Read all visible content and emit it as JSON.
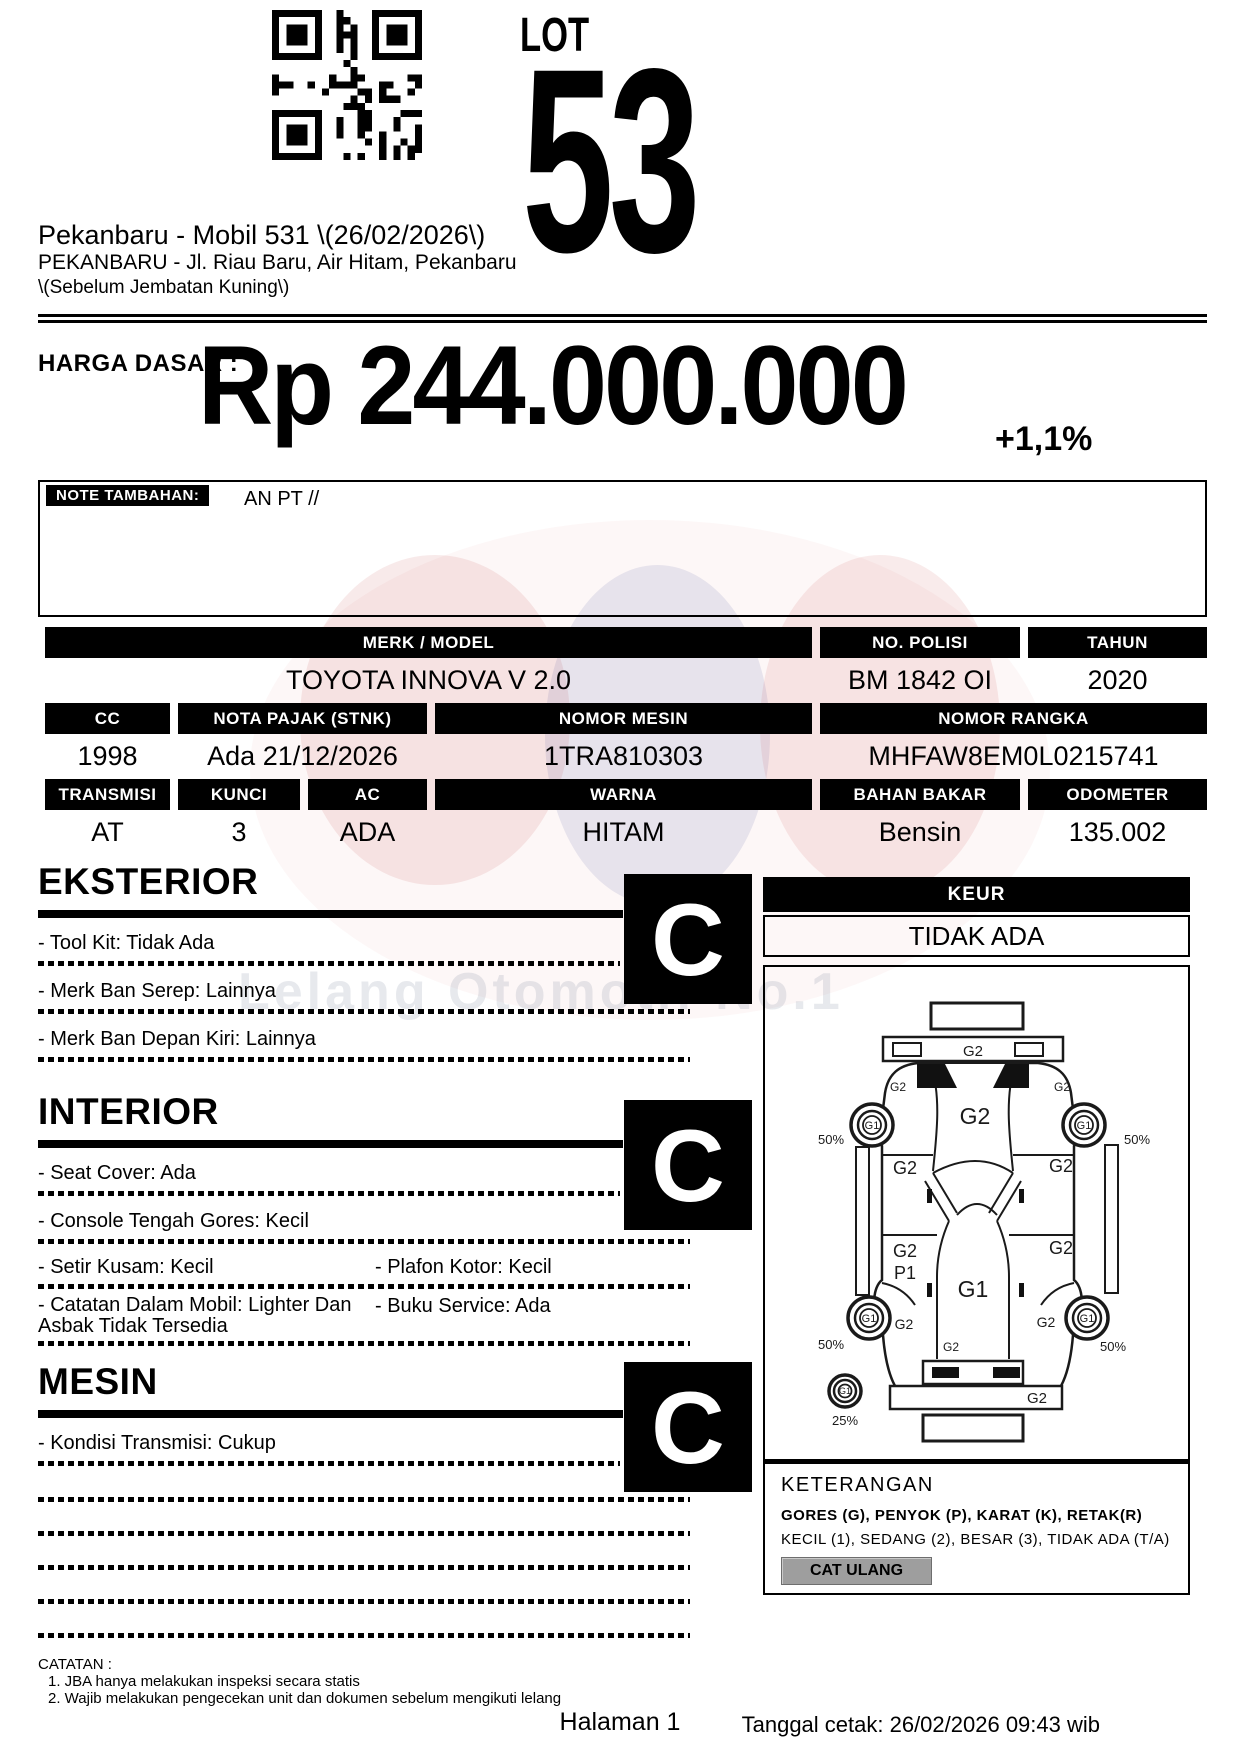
{
  "page": {
    "lot_label": "LOT",
    "lot_number": "53",
    "title": "Pekanbaru - Mobil 531 \\(26/02/2026\\)",
    "address1": "PEKANBARU - Jl. Riau Baru, Air Hitam, Pekanbaru",
    "address2": "\\(Sebelum Jembatan Kuning\\)"
  },
  "price": {
    "label": "HARGA DASAR :",
    "amount": "Rp 244.000.000",
    "change_pct": "+1,1%"
  },
  "note": {
    "label": "NOTE TAMBAHAN:",
    "value": "AN PT //"
  },
  "specs": {
    "merk_model": {
      "label": "MERK / MODEL",
      "value": "TOYOTA INNOVA V 2.0"
    },
    "no_polisi": {
      "label": "NO. POLISI",
      "value": "BM 1842 OI"
    },
    "tahun": {
      "label": "TAHUN",
      "value": "2020"
    },
    "cc": {
      "label": "CC",
      "value": "1998"
    },
    "nota_pajak": {
      "label": "NOTA PAJAK (STNK)",
      "value": "Ada 21/12/2026"
    },
    "nomor_mesin": {
      "label": "NOMOR MESIN",
      "value": "1TRA810303"
    },
    "nomor_rangka": {
      "label": "NOMOR RANGKA",
      "value": "MHFAW8EM0L0215741"
    },
    "transmisi": {
      "label": "TRANSMISI",
      "value": "AT"
    },
    "kunci": {
      "label": "KUNCI",
      "value": "3"
    },
    "ac": {
      "label": "AC",
      "value": "ADA"
    },
    "warna": {
      "label": "WARNA",
      "value": "HITAM"
    },
    "bahan_bakar": {
      "label": "BAHAN BAKAR",
      "value": "Bensin"
    },
    "odometer": {
      "label": "ODOMETER",
      "value": "135.002"
    }
  },
  "sections": {
    "eksterior": {
      "title": "EKSTERIOR",
      "grade": "C",
      "items": [
        "- Tool Kit: Tidak Ada",
        "- Merk Ban Serep: Lainnya",
        "- Merk Ban Depan Kiri: Lainnya"
      ]
    },
    "interior": {
      "title": "INTERIOR",
      "grade": "C",
      "items_full": [
        "- Seat Cover: Ada",
        "- Console Tengah Gores: Kecil"
      ],
      "items_pairs": [
        {
          "left": "- Setir Kusam: Kecil",
          "right": "- Plafon Kotor: Kecil"
        },
        {
          "left": "- Catatan Dalam Mobil: Lighter Dan Asbak Tidak Tersedia",
          "right": "- Buku Service: Ada"
        }
      ]
    },
    "mesin": {
      "title": "MESIN",
      "grade": "C",
      "items": [
        "- Kondisi Transmisi: Cukup"
      ]
    }
  },
  "keur": {
    "label": "KEUR",
    "value": "TIDAK ADA"
  },
  "diagram": {
    "labels": {
      "rear_bar": "G2",
      "pillar_rl": "G2",
      "pillar_rr": "G2",
      "roof": "G2",
      "quarter_left": "G2",
      "quarter_right": "G2",
      "door_left_g": "G2",
      "door_left_p": "P1",
      "door_right": "G2",
      "hood": "G1",
      "cowl": "G2",
      "fender_fl": "G2",
      "fender_fr": "G2",
      "bumper": "G2",
      "wheel_rl": "G1",
      "wheel_rr": "G1",
      "wheel_fl": "G1",
      "wheel_fr": "G1",
      "wheel_spare": "G1",
      "pct_rl": "50%",
      "pct_rr": "50%",
      "pct_fl": "50%",
      "pct_fr": "50%",
      "pct_spare": "25%"
    }
  },
  "keterangan": {
    "title": "KETERANGAN",
    "line1": "GORES (G), PENYOK (P), KARAT (K), RETAK(R)",
    "line2": "KECIL (1), SEDANG (2), BESAR (3), TIDAK ADA (T/A)",
    "badge": "CAT ULANG"
  },
  "catatan": {
    "title": "CATATAN :",
    "items": [
      "1. JBA hanya melakukan inspeksi secara statis",
      "2. Wajib melakukan pengecekan unit dan dokumen sebelum mengikuti lelang"
    ]
  },
  "footer": {
    "page_number": "Halaman 1",
    "printed": "Tanggal cetak: 26/02/2026 09:43 wib"
  },
  "watermark": {
    "text": "Lelang Otomotif No.1"
  },
  "colors": {
    "badge_bg": "#9e9e9e",
    "watermark_red": "#c23c3c",
    "watermark_blue": "#4650a0"
  }
}
